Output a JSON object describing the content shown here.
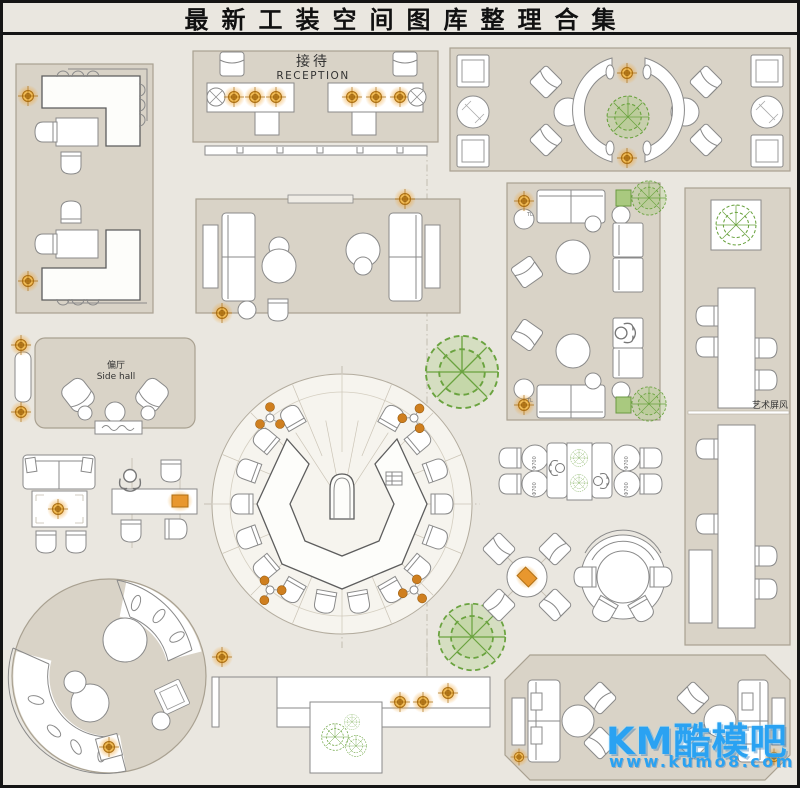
{
  "title": "最新工装空间图库整理合集",
  "labels": {
    "reception_cn": "接待",
    "reception_en": "RECEPTION",
    "side_hall_cn": "偏厅",
    "side_hall_en": "Side hall",
    "art_screen": "艺术屏风",
    "table_lamp": "TL",
    "table_diameter": "Φ700"
  },
  "watermark": {
    "brand": "KM酷模吧",
    "url": "www.kumo8.com"
  },
  "colors": {
    "page_bg": "#eae7e0",
    "zone_bg": "#d9d3c7",
    "zone_border": "#a9a191",
    "line": "#8a8a8a",
    "accent_orange": "#e0921f",
    "plant_green": "#6aa33f",
    "watermark_blue": "#2aa2f2",
    "title_color": "#111111"
  }
}
